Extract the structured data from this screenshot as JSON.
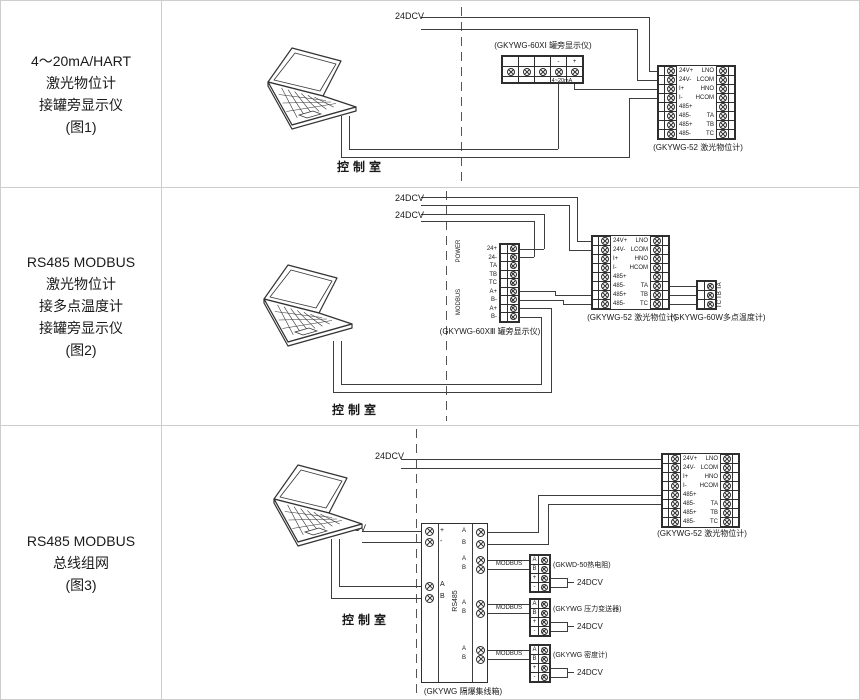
{
  "sidebar": {
    "rows": [
      [
        "4～20mA/HART",
        "激光物位计",
        "接罐旁显示仪",
        "(图1)"
      ],
      [
        "RS485 MODBUS",
        "激光物位计",
        "接多点温度计",
        "接罐旁显示仪",
        "(图2)"
      ],
      [
        "RS485 MODBUS",
        "总线组网",
        "(图3)"
      ]
    ]
  },
  "shared": {
    "control_room": "控制室",
    "power_supply": "24DCV",
    "modbus_label": "MODBUS",
    "laser_meter": {
      "caption": "(GKYWG-52 激光物位计)",
      "left_terminals": [
        "24V+",
        "24V-",
        "I+",
        "I-",
        "485+",
        "485-",
        "485+",
        "485-"
      ],
      "right_terminals": [
        "LNO",
        "LCOM",
        "HNO",
        "HCOM",
        "",
        "TA",
        "TB",
        "TC"
      ]
    }
  },
  "fig1": {
    "display": {
      "caption": "(GKYWG-60XⅠ 罐旁显示仪)",
      "terminal_labels": [
        "",
        "",
        "",
        "-",
        "+"
      ],
      "signal_label": "4~20mA"
    }
  },
  "fig2": {
    "display": {
      "caption": "(GKYWG-60XⅢ 罐旁显示仪)",
      "terminal_labels": [
        "24+",
        "24-",
        "TA",
        "TB",
        "TC",
        "A+",
        "B-",
        "A+",
        "B-"
      ],
      "group_power": "POWER",
      "group_modbus": "MODBUS"
    },
    "temp_meter": {
      "caption": "(GKYWG-60W多点温度计)",
      "terminal_labels": [
        "TA",
        "TB",
        "TC"
      ]
    }
  },
  "fig3": {
    "junction_box": {
      "caption": "(GKYWG 隔爆集线箱)",
      "bus_label": "RS485",
      "power_terminals": [
        "+",
        "-"
      ],
      "pc_terminals": [
        "A",
        "B"
      ],
      "out_terminals": [
        "A",
        "B"
      ]
    },
    "devices": [
      {
        "caption": "(GKWD-50热电阻)",
        "terminals": [
          "A",
          "B",
          "+",
          "-"
        ],
        "power": "24DCV"
      },
      {
        "caption": "(GKYWG 压力变送器)",
        "terminals": [
          "A",
          "B",
          "+",
          "-"
        ],
        "power": "24DCV"
      },
      {
        "caption": "(GKYWG 密度计)",
        "terminals": [
          "A",
          "B",
          "+",
          "-"
        ],
        "power": "24DCV"
      }
    ]
  }
}
